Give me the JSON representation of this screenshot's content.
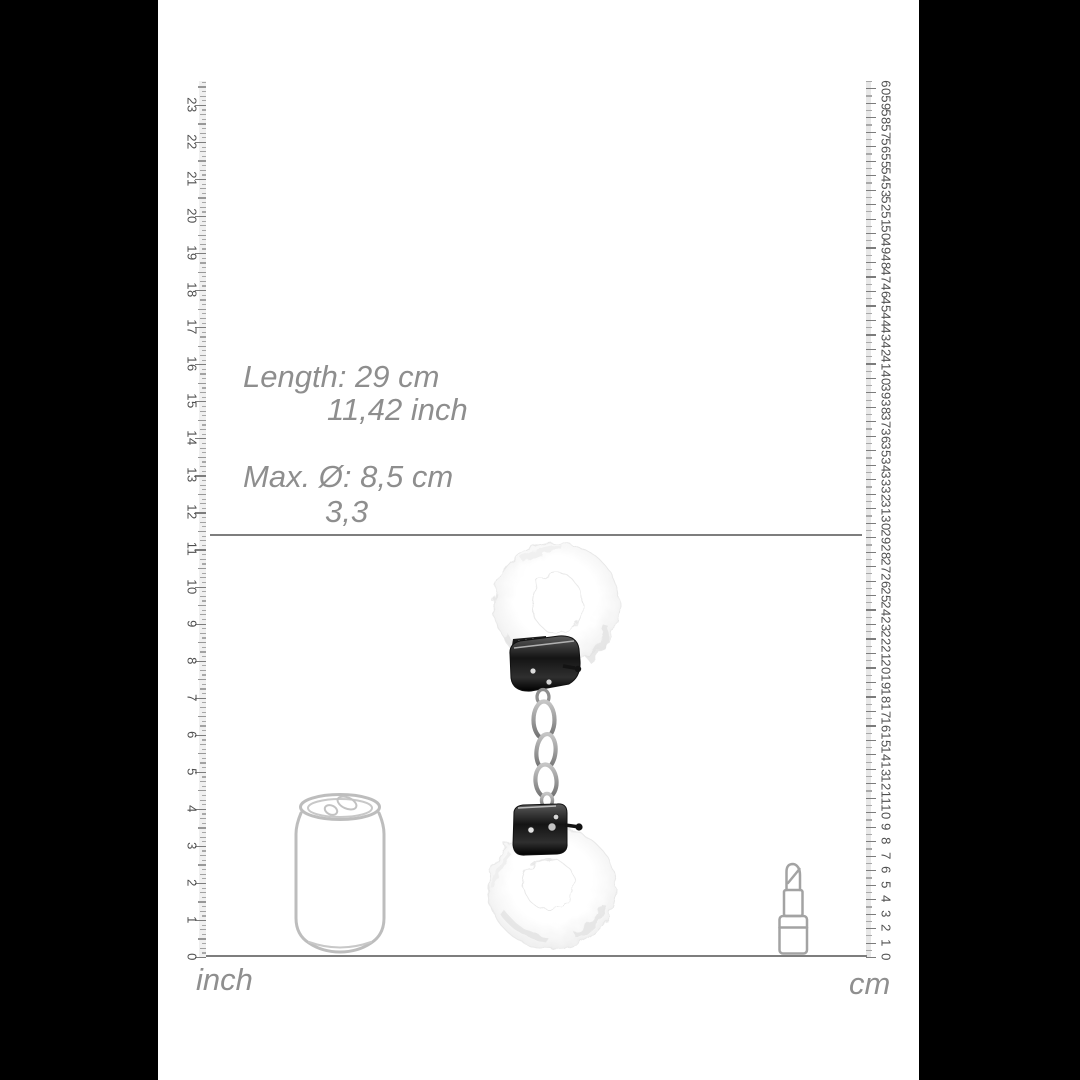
{
  "annotations": {
    "length_line1": "Length: 29 cm",
    "length_line2": "11,42 inch",
    "diameter_line1": "Max. Ø: 8,5 cm",
    "diameter_line2": "3,3",
    "text_color": "#8e8e8e"
  },
  "marker": {
    "length_cm": 29,
    "line_y": 534,
    "line_x1": 210,
    "line_x2": 862,
    "baseline_y": 955,
    "baseline_x1": 206,
    "baseline_x2": 867
  },
  "rulers": {
    "inch": {
      "label": "inch",
      "side": "left",
      "labels": [
        0,
        1,
        2,
        3,
        4,
        5,
        6,
        7,
        8,
        9,
        10,
        11,
        12,
        13,
        14,
        15,
        16,
        17,
        18,
        19,
        20,
        21,
        22,
        23
      ],
      "px_per_unit": 37.05,
      "origin_y": 957,
      "edge_x": 206,
      "ticks_per_unit": 8,
      "extra_units": 0.625,
      "num_x": 192
    },
    "cm": {
      "label": "cm",
      "side": "right",
      "labels": [
        0,
        1,
        2,
        3,
        4,
        5,
        6,
        7,
        8,
        9,
        10,
        11,
        12,
        13,
        14,
        15,
        16,
        17,
        18,
        19,
        20,
        21,
        22,
        23,
        24,
        25,
        26,
        27,
        28,
        29,
        30,
        31,
        32,
        33,
        34,
        35,
        36,
        37,
        38,
        39,
        40,
        41,
        42,
        43,
        44,
        45,
        46,
        47,
        48,
        49,
        50,
        51,
        52,
        53,
        54,
        55,
        56,
        57,
        58,
        59,
        60
      ],
      "px_per_unit": 14.48,
      "origin_y": 957,
      "edge_x": 866,
      "ticks_per_unit": 2,
      "extra_units": 0.5,
      "num_x": 886
    }
  },
  "objects": {
    "product": "fluffy-handcuffs",
    "reference_1": "soda-can",
    "reference_2": "lipstick"
  },
  "colors": {
    "background": "#ffffff",
    "side_bars": "#000000",
    "tick_major": "#7c7c7c",
    "tick_minor": "#a8a8a8",
    "line_gray": "#7e7e7e",
    "outline_gray": "#bdbdbd"
  }
}
